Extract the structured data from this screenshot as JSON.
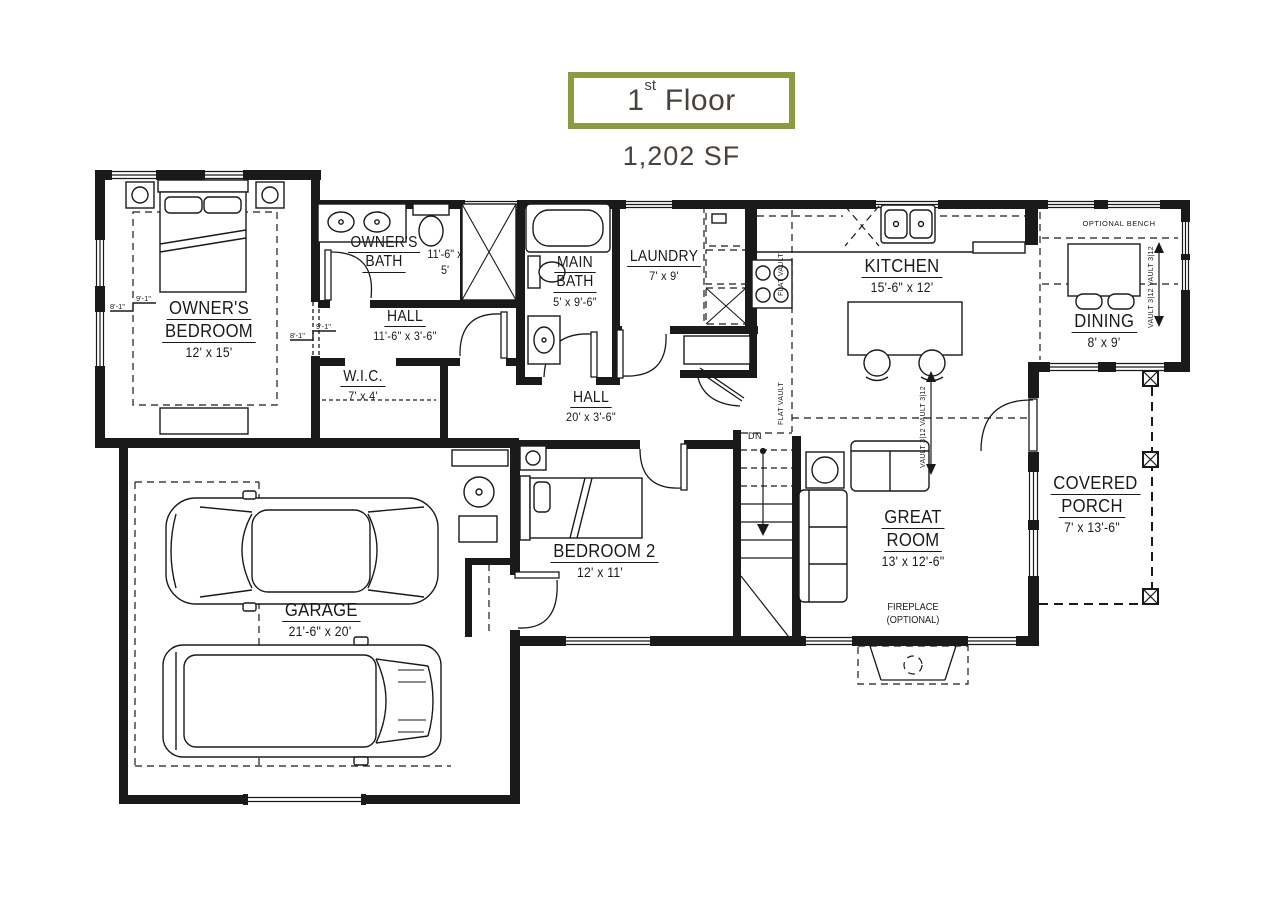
{
  "header": {
    "title_number": "1",
    "title_suffix": "st",
    "title_rest": " Floor",
    "area": "1,202 SF"
  },
  "colors": {
    "accent_border": "#8a9b42",
    "heading_text": "#4a423c",
    "line_ink": "#1a1a1a"
  },
  "rooms": [
    {
      "id": "owners-bedroom",
      "lines": [
        "OWNER'S",
        "BEDROOM"
      ],
      "dims": "12' x 15'"
    },
    {
      "id": "owners-bath",
      "lines": [
        "OWNER'S",
        "BATH"
      ],
      "dims": "11'-6\" x 5'"
    },
    {
      "id": "hall-upper",
      "lines": [
        "HALL"
      ],
      "dims": "11'-6\" x 3'-6\""
    },
    {
      "id": "wic",
      "lines": [
        "W.I.C."
      ],
      "dims": "7' x 4'"
    },
    {
      "id": "main-bath",
      "lines": [
        "MAIN",
        "BATH"
      ],
      "dims": "5' x 9'-6\""
    },
    {
      "id": "laundry",
      "lines": [
        "LAUNDRY"
      ],
      "dims": "7' x 9'"
    },
    {
      "id": "kitchen",
      "lines": [
        "KITCHEN"
      ],
      "dims": "15'-6\" x 12'"
    },
    {
      "id": "dining",
      "lines": [
        "DINING"
      ],
      "dims": "8' x 9'"
    },
    {
      "id": "hall-main",
      "lines": [
        "HALL"
      ],
      "dims": "20' x 3'-6\""
    },
    {
      "id": "bedroom-2",
      "lines": [
        "BEDROOM 2"
      ],
      "dims": "12' x 11'"
    },
    {
      "id": "great-room",
      "lines": [
        "GREAT",
        "ROOM"
      ],
      "dims": "13' x 12'-6\""
    },
    {
      "id": "garage",
      "lines": [
        "GARAGE"
      ],
      "dims": "21'-6\" x 20'"
    },
    {
      "id": "covered-porch",
      "lines": [
        "COVERED",
        "PORCH"
      ],
      "dims": "7' x 13'-6\""
    }
  ],
  "annotations": {
    "fireplace_line1": "FIREPLACE",
    "fireplace_line2": "(OPTIONAL)",
    "optional_bench": "OPTIONAL BENCH",
    "down_label": "DN",
    "flat_vault": "FLAT VAULT",
    "vault_slope": "VAULT 3|12  VAULT 3|12",
    "ceiling_high": "9'-1\"",
    "ceiling_low": "8'-1\""
  }
}
